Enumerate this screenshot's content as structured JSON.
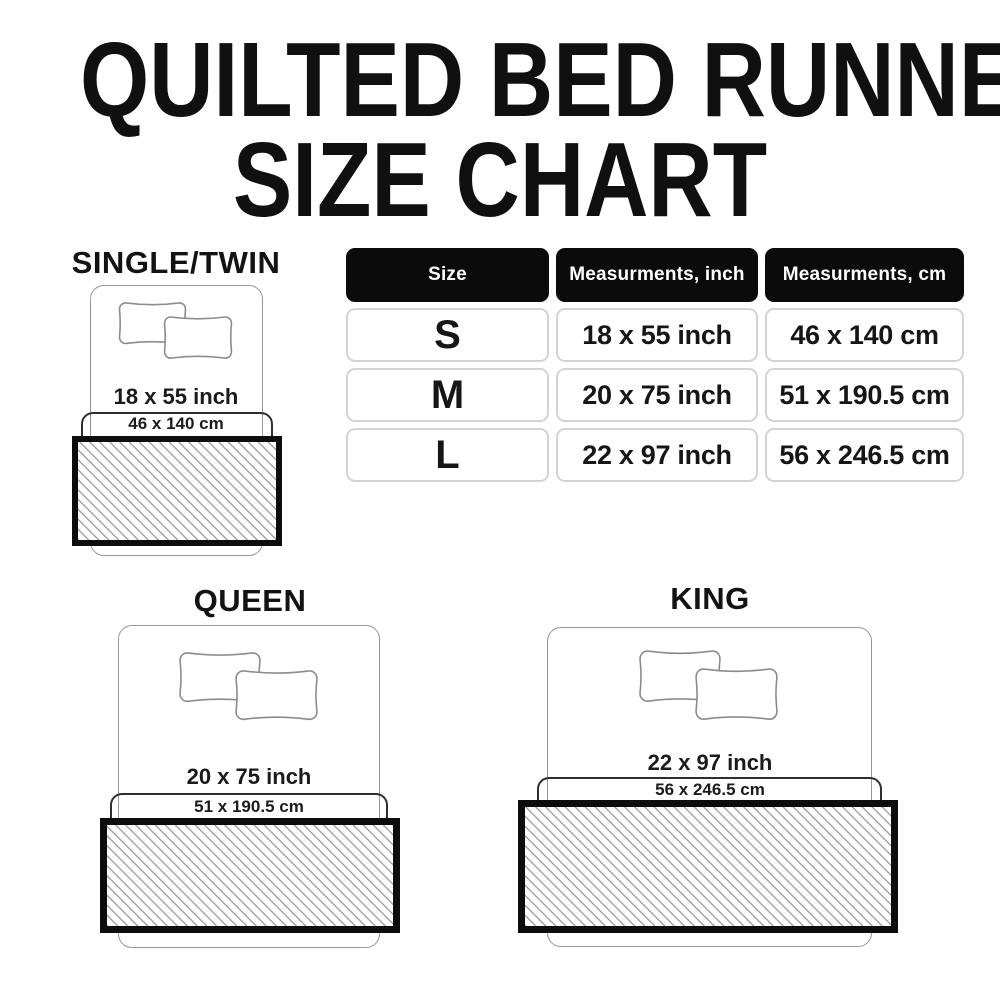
{
  "title": {
    "line1": "QUILTED BED RUNNER",
    "line2": "SIZE CHART"
  },
  "table": {
    "headers": [
      "Size",
      "Measurments, inch",
      "Measurments, cm"
    ],
    "rows": [
      {
        "size": "S",
        "inch": "18 x 55 inch",
        "cm": "46 x 140 cm"
      },
      {
        "size": "M",
        "inch": "20 x 75 inch",
        "cm": "51 x 190.5 cm"
      },
      {
        "size": "L",
        "inch": "22 x 97 inch",
        "cm": "56 x 246.5 cm"
      }
    ]
  },
  "sections": {
    "single": {
      "label": "SINGLE/TWIN",
      "inch": "18 x 55 inch",
      "cm": "46 x 140 cm"
    },
    "queen": {
      "label": "QUEEN",
      "inch": "20 x 75 inch",
      "cm": "51 x 190.5 cm"
    },
    "king": {
      "label": "KING",
      "inch": "22 x 97 inch",
      "cm": "56 x 246.5 cm"
    }
  },
  "colors": {
    "header_bg": "#0b0b0b",
    "header_text": "#ffffff",
    "cell_border": "#d0d4d9",
    "bed_outline": "#979797",
    "bracket_line": "#2e2e2e",
    "hatch_line": "#a4a4a4",
    "runner_border": "#0d0d0d",
    "text": "#141414"
  }
}
